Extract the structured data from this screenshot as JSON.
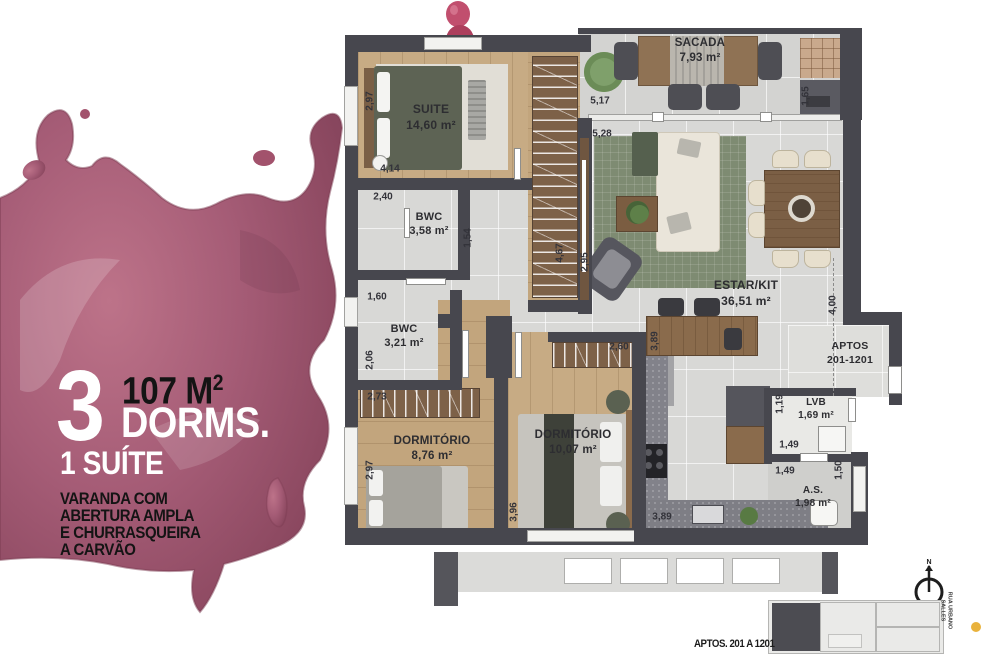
{
  "left_panel": {
    "big_number": "3",
    "area_value": "107 M",
    "area_sup": "2",
    "dorms_label": "DORMS.",
    "suite_line": "1 SUÍTE",
    "features": [
      "VARANDA COM",
      "ABERTURA AMPLA",
      "E CHURRASQUEIRA",
      "A CARVÃO"
    ],
    "splash_color": "#a0546e"
  },
  "plan": {
    "rooms": [
      {
        "name": "SUITE",
        "area": "14,60 m²"
      },
      {
        "name": "SACADA",
        "area": "7,93 m²"
      },
      {
        "name": "BWC",
        "area": "3,58 m²"
      },
      {
        "name": "BWC",
        "area": "3,21 m²"
      },
      {
        "name": "ESTAR/KIT",
        "area": "36,51 m²"
      },
      {
        "name": "DORMITÓRIO",
        "area": "8,76 m²"
      },
      {
        "name": "DORMITÓRIO",
        "area": "10,07 m²"
      },
      {
        "name": "APTOS",
        "area": "201-1201"
      },
      {
        "name": "LVB",
        "area": "1,69 m²"
      },
      {
        "name": "A.S.",
        "area": "1,98 m²"
      }
    ],
    "dimensions": [
      "2,97",
      "4,14",
      "5,17",
      "1,65",
      "5,28",
      "4,67",
      "2,95",
      "2,40",
      "1,54",
      "1,60",
      "2,06",
      "2,73",
      "2,97",
      "3,96",
      "2,60",
      "3,89",
      "3,89",
      "4,00",
      "1,19",
      "1,49",
      "1,49",
      "1,50"
    ],
    "wall_color": "#47474e"
  },
  "footer": {
    "keyplan_label": "APTOS. 201 A 1201",
    "street_line1": "RUA URBANO",
    "street_line2": "SALLES",
    "compass_label": "N",
    "marker_color": "#e9b23c"
  }
}
